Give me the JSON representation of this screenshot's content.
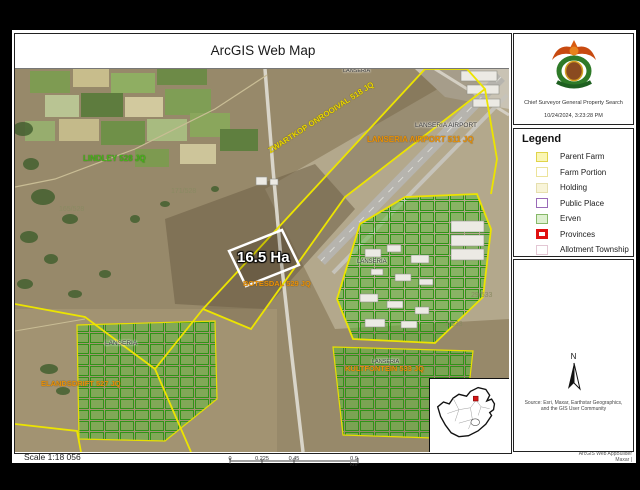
{
  "page": {
    "title": "ArcGIS Web Map",
    "scale_text": "Scale 1:18 056",
    "footer_line1": "ArcGIS Web AppBuilder",
    "footer_line2": "Maxar |"
  },
  "header_panel": {
    "emblem": "south-africa-coat-of-arms",
    "caption": "Chief Surveyor General Property Search",
    "timestamp": "10/24/2024, 3:23:28 PM"
  },
  "legend": {
    "title": "Legend",
    "items": [
      {
        "label": "Parent Farm",
        "fill": "#faf6b4",
        "border": "#e0d44a"
      },
      {
        "label": "Farm Portion",
        "fill": "#ffffff",
        "border": "#ece39a"
      },
      {
        "label": "Holding",
        "fill": "#f8f4d8",
        "border": "#e6dfae"
      },
      {
        "label": "Public Place",
        "fill": "#ffffff",
        "border": "#9a6ab8"
      },
      {
        "label": "Erven",
        "fill": "#def0d0",
        "border": "#86b868"
      },
      {
        "label": "Provinces",
        "fill": "#ffffff",
        "border": "#e01010"
      },
      {
        "label": "Allotment Township",
        "fill": "#ffffff",
        "border": "#e3c7d4"
      }
    ]
  },
  "map": {
    "north_label": "N",
    "source_line1": "Source: Esri, Maxar, Earthstar Geographics,",
    "source_line2": "and the GIS User Community",
    "scalebar_ticks": [
      "0",
      "0.225",
      "0.45",
      "0.9 km"
    ],
    "boundary_color": "#ece400",
    "highlight_area_color": "#ffffff",
    "labels": [
      {
        "text": "LANSERIA"
      },
      {
        "text": "LINDLEY 528 JQ"
      },
      {
        "text": "171/528"
      },
      {
        "text": "165/528"
      },
      {
        "text": "ZWARTKOP ONROOIVAL 518 JQ"
      },
      {
        "text": "LANSERIA AIRPORT"
      },
      {
        "text": "LANSERIA AIRPORT 511 JQ"
      },
      {
        "text": "16.5 Ha"
      },
      {
        "text": "BOTESDAL 529 JQ"
      },
      {
        "text": "LANSERIA"
      },
      {
        "text": "LANSERIA"
      },
      {
        "text": "LANSERIA"
      },
      {
        "text": "KULTFONTEIN 533 JQ"
      },
      {
        "text": "ELANDSDRIFT 527 JQ"
      },
      {
        "text": "29/533"
      },
      {
        "text": "2/533"
      }
    ]
  }
}
